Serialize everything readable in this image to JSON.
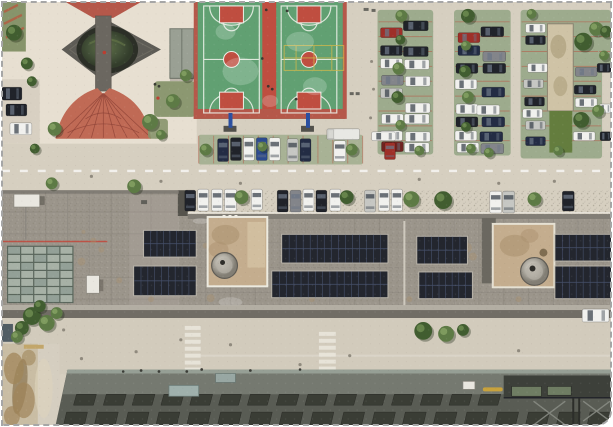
{
  "image": {
    "kind": "aerial-drone-photo",
    "caption": "Top-down drone view of a campus block: plaza with circular pond, two basketball courts, tree-lined parking lots full of cars, a long rooftop with solar panel arrays and two dome skylights, zebra crosswalks, and a dark building facade at the bottom"
  },
  "colors": {
    "base": "#d6cfc0",
    "plaza": "#e7dfd1",
    "streetTint": "#d8d0c2",
    "southRoad": "#d2cbbc",
    "lawn": "#87946b",
    "treeDark": "#415d30",
    "treeMid": "#5d7a45",
    "brickRed": "#b5584a",
    "fanRed": "#c06a55",
    "fanLine": "#8c4136",
    "diamond": "#5d5b55",
    "walk": "#6b6760",
    "pondRim": "#2c2f27",
    "canopy": "#9aa094",
    "courtGreen": "#61a072",
    "courtRed": "#bf4e40",
    "courtLine": "#edf1e9",
    "courtYellow": "#cfb84b",
    "postBlue": "#2b4fa0",
    "bayGreen": "#9dab8d",
    "bayLine": "#b5604c",
    "bandGreen": "#a8b295",
    "shed": "#cfc3a6",
    "shedLawn": "#647d3e",
    "roof": "#9b958b",
    "annexEast": "#a49e94",
    "parapetDark": "#716d65",
    "parapetLight": "#b3aea3",
    "gap": "#55534c",
    "redLine": "#c2473a",
    "skyFrame": "#5a665c",
    "skyPaneA": "#a7b1a6",
    "skyPaneB": "#93a097",
    "unit": "#e9e7e0",
    "solar": "#23262e",
    "solarLine": "#46506a",
    "solarFrame": "#bdb9ae",
    "penthouse": "#c4ad8e",
    "penthouse2": "#d3c0a1",
    "stain": "#a9906d",
    "domeDark": "#5f5c55",
    "darkStrip": "#6b6860",
    "crosswalk": "#e9e6dc",
    "dirt": "#c9bda4",
    "dirtBrown": "#a0855a",
    "mud": "#8a7550",
    "buildTop": "#757970",
    "buildFace": "#595c54",
    "buildEdge": "#9aa399",
    "buildWin": "#3a3d35",
    "teal": "#9fb0ac",
    "equip": "#3d403a",
    "equipGreen": "#6f7d63",
    "pipeYellow": "#c8a23c",
    "pipeGray": "#8b8e86",
    "spotMap": {
      "red": "#c23b2e",
      "dark": "#33342f",
      "gray": "#66655e",
      "man": "#8a8478"
    },
    "carColors": {
      "white": "#f1f1ee",
      "black": "#20232a",
      "silver": "#c6c7c3",
      "red": "#9e2f28",
      "blue": "#2c4a8e",
      "navy": "#232c44",
      "gray": "#83858a",
      "maroon": "#6e2320",
      "truck": "#e8e8e4"
    }
  },
  "scene": {
    "cars": [
      [
        381,
        26,
        22,
        10,
        "red"
      ],
      [
        404,
        19,
        25,
        10,
        "black"
      ],
      [
        381,
        44,
        22,
        10,
        "black"
      ],
      [
        404,
        45,
        25,
        10,
        "black"
      ],
      [
        381,
        57,
        22,
        10,
        "white"
      ],
      [
        405,
        58,
        25,
        10,
        "white"
      ],
      [
        382,
        74,
        22,
        10,
        "gray"
      ],
      [
        406,
        75,
        25,
        10,
        "white"
      ],
      [
        381,
        87,
        22,
        10,
        "silver"
      ],
      [
        406,
        102,
        25,
        10,
        "white"
      ],
      [
        382,
        113,
        22,
        10,
        "white"
      ],
      [
        405,
        113,
        25,
        10,
        "white"
      ],
      [
        381,
        130,
        22,
        10,
        "white"
      ],
      [
        406,
        131,
        25,
        10,
        "white"
      ],
      [
        382,
        141,
        22,
        10,
        "maroon"
      ],
      [
        405,
        142,
        25,
        10,
        "white"
      ],
      [
        459,
        31,
        22,
        10,
        "red"
      ],
      [
        482,
        25,
        23,
        10,
        "black"
      ],
      [
        459,
        44,
        22,
        10,
        "navy"
      ],
      [
        484,
        50,
        23,
        10,
        "gray"
      ],
      [
        457,
        62,
        22,
        10,
        "black"
      ],
      [
        484,
        62,
        23,
        10,
        "black"
      ],
      [
        456,
        78,
        22,
        10,
        "white"
      ],
      [
        483,
        86,
        23,
        10,
        "navy"
      ],
      [
        457,
        103,
        22,
        10,
        "white"
      ],
      [
        478,
        104,
        23,
        10,
        "white"
      ],
      [
        457,
        116,
        22,
        10,
        "black"
      ],
      [
        483,
        116,
        23,
        10,
        "navy"
      ],
      [
        456,
        130,
        22,
        10,
        "white"
      ],
      [
        481,
        131,
        23,
        10,
        "navy"
      ],
      [
        458,
        142,
        22,
        10,
        "white"
      ],
      [
        482,
        143,
        23,
        10,
        "gray"
      ],
      [
        527,
        22,
        20,
        9,
        "white"
      ],
      [
        527,
        34,
        20,
        9,
        "black"
      ],
      [
        529,
        62,
        20,
        9,
        "white"
      ],
      [
        525,
        78,
        20,
        9,
        "silver"
      ],
      [
        526,
        96,
        20,
        9,
        "black"
      ],
      [
        524,
        108,
        20,
        9,
        "white"
      ],
      [
        527,
        120,
        20,
        9,
        "silver"
      ],
      [
        527,
        136,
        20,
        9,
        "navy"
      ],
      [
        577,
        66,
        22,
        9,
        "gray"
      ],
      [
        576,
        84,
        22,
        9,
        "black"
      ],
      [
        577,
        97,
        22,
        9,
        "white"
      ],
      [
        575,
        131,
        22,
        9,
        "white"
      ],
      [
        599,
        62,
        14,
        9,
        "black"
      ],
      [
        601,
        103,
        12,
        9,
        "white"
      ],
      [
        602,
        131,
        11,
        9,
        "black"
      ],
      [
        217,
        138,
        11,
        23,
        "navy"
      ],
      [
        230,
        137,
        11,
        23,
        "black"
      ],
      [
        243,
        137,
        11,
        23,
        "white"
      ],
      [
        256,
        137,
        11,
        23,
        "blue"
      ],
      [
        269,
        137,
        11,
        23,
        "white"
      ],
      [
        287,
        138,
        11,
        23,
        "silver"
      ],
      [
        300,
        138,
        11,
        23,
        "navy"
      ],
      [
        334,
        140,
        12,
        21,
        "white"
      ],
      [
        327,
        128,
        33,
        11,
        "truck"
      ],
      [
        372,
        131,
        24,
        9,
        "white"
      ],
      [
        385,
        142,
        11,
        17,
        "red"
      ],
      [
        184,
        190,
        11,
        21,
        "black"
      ],
      [
        197,
        189,
        11,
        22,
        "white"
      ],
      [
        211,
        189,
        11,
        22,
        "white"
      ],
      [
        224,
        189,
        12,
        22,
        "white"
      ],
      [
        251,
        189,
        11,
        21,
        "white"
      ],
      [
        277,
        190,
        11,
        22,
        "black"
      ],
      [
        290,
        190,
        11,
        22,
        "gray"
      ],
      [
        303,
        189,
        11,
        22,
        "white"
      ],
      [
        316,
        190,
        11,
        22,
        "black"
      ],
      [
        330,
        189,
        11,
        22,
        "white"
      ],
      [
        365,
        190,
        11,
        22,
        "silver"
      ],
      [
        379,
        189,
        11,
        22,
        "white"
      ],
      [
        392,
        189,
        11,
        22,
        "white"
      ],
      [
        491,
        191,
        12,
        22,
        "white"
      ],
      [
        504,
        191,
        12,
        22,
        "silver"
      ],
      [
        564,
        191,
        12,
        20,
        "black"
      ],
      [
        0,
        86,
        20,
        13,
        "black"
      ],
      [
        4,
        103,
        21,
        12,
        "black"
      ],
      [
        8,
        122,
        22,
        12,
        "white"
      ],
      [
        584,
        310,
        27,
        13,
        "white"
      ]
    ],
    "trees": [
      [
        12,
        31,
        8,
        "d"
      ],
      [
        25,
        62,
        6,
        "d"
      ],
      [
        30,
        80,
        5,
        "d"
      ],
      [
        33,
        148,
        5,
        "d"
      ],
      [
        53,
        128,
        7,
        "m"
      ],
      [
        149,
        121,
        8,
        "m"
      ],
      [
        160,
        134,
        5,
        "m"
      ],
      [
        172,
        100,
        7,
        "m"
      ],
      [
        185,
        74,
        6,
        "m"
      ],
      [
        50,
        183,
        6,
        "m"
      ],
      [
        133,
        186,
        7,
        "m"
      ],
      [
        205,
        149,
        6,
        "m"
      ],
      [
        262,
        146,
        5,
        "m"
      ],
      [
        352,
        149,
        6,
        "m"
      ],
      [
        402,
        14,
        6,
        "m"
      ],
      [
        401,
        38,
        5,
        "d"
      ],
      [
        399,
        67,
        6,
        "m"
      ],
      [
        398,
        96,
        6,
        "d"
      ],
      [
        401,
        124,
        5,
        "m"
      ],
      [
        469,
        14,
        7,
        "d"
      ],
      [
        467,
        44,
        5,
        "m"
      ],
      [
        466,
        70,
        6,
        "d"
      ],
      [
        469,
        96,
        6,
        "m"
      ],
      [
        467,
        126,
        5,
        "d"
      ],
      [
        472,
        148,
        5,
        "m"
      ],
      [
        533,
        12,
        5,
        "m"
      ],
      [
        585,
        40,
        9,
        "d"
      ],
      [
        598,
        27,
        7,
        "m"
      ],
      [
        583,
        119,
        8,
        "d"
      ],
      [
        600,
        110,
        6,
        "m"
      ],
      [
        560,
        150,
        5,
        "m"
      ],
      [
        420,
        150,
        5,
        "m"
      ],
      [
        490,
        152,
        5,
        "m"
      ],
      [
        608,
        30,
        6,
        "d"
      ],
      [
        606,
        54,
        5,
        "m"
      ],
      [
        241,
        197,
        7,
        "m"
      ],
      [
        347,
        197,
        7,
        "d"
      ],
      [
        412,
        199,
        8,
        "m"
      ],
      [
        444,
        200,
        9,
        "d"
      ],
      [
        536,
        199,
        7,
        "m"
      ],
      [
        424,
        332,
        9,
        "d"
      ],
      [
        447,
        335,
        8,
        "m"
      ],
      [
        464,
        331,
        6,
        "d"
      ],
      [
        30,
        317,
        9,
        "d"
      ],
      [
        45,
        324,
        8,
        "m"
      ],
      [
        20,
        329,
        7,
        "d"
      ],
      [
        55,
        314,
        6,
        "m"
      ],
      [
        38,
        307,
        6,
        "d"
      ],
      [
        15,
        338,
        6,
        "m"
      ]
    ],
    "solar": [
      [
        143,
        231,
        52,
        26,
        8
      ],
      [
        133,
        267,
        62,
        29,
        9
      ],
      [
        282,
        235,
        106,
        28,
        15
      ],
      [
        272,
        272,
        116,
        26,
        16
      ],
      [
        418,
        237,
        50,
        27,
        7
      ],
      [
        420,
        273,
        53,
        26,
        8
      ],
      [
        557,
        235,
        56,
        26,
        8
      ],
      [
        557,
        267,
        56,
        32,
        8
      ]
    ],
    "bays": [
      {
        "x": 378,
        "y": 8,
        "w": 56,
        "h": 146
      },
      {
        "x": 455,
        "y": 8,
        "w": 57,
        "h": 147
      },
      {
        "x": 522,
        "y": 8,
        "w": 82,
        "h": 150
      },
      {
        "x": 600,
        "y": 8,
        "w": 13,
        "h": 60
      }
    ],
    "band": {
      "x": 198,
      "y": 134,
      "w": 165,
      "h": 30,
      "step": 15
    },
    "bayStep": 15,
    "skylight": {
      "x": 5,
      "y": 246,
      "w": 67,
      "h": 58,
      "cols": 5,
      "rows": 7
    },
    "crosswalks": [
      {
        "x": 184,
        "y": 327,
        "w": 16,
        "bar": 4,
        "gap": 3,
        "n": 7
      },
      {
        "x": 319,
        "y": 333,
        "w": 17,
        "bar": 4,
        "gap": 3,
        "n": 6
      }
    ],
    "windows": {
      "rows": [
        {
          "y": 396,
          "h": 11,
          "w": 20,
          "xs": [
            72,
            102,
            131,
            160,
            189,
            218,
            247,
            276,
            305,
            334,
            363,
            392,
            421,
            450,
            479
          ]
        },
        {
          "y": 414,
          "h": 13,
          "w": 21,
          "xs": [
            62,
            93,
            124,
            155,
            186,
            217,
            248,
            279,
            310,
            341,
            372,
            403,
            434,
            465,
            496,
            527,
            558,
            589
          ]
        }
      ]
    },
    "spots": [
      [
        103,
        51,
        1.8,
        "red"
      ],
      [
        157,
        97,
        1.6,
        "red"
      ],
      [
        154,
        83,
        1.4,
        "dark"
      ],
      [
        158,
        85,
        1.4,
        "dark"
      ],
      [
        266,
        8,
        1.4,
        "dark"
      ],
      [
        287,
        9,
        1.4,
        "dark"
      ],
      [
        268,
        85,
        1.4,
        "dark"
      ],
      [
        272,
        88,
        1.4,
        "dark"
      ],
      [
        296,
        98,
        1.4,
        "dark"
      ],
      [
        262,
        57,
        1.3,
        "dark"
      ],
      [
        140,
        372,
        1.4,
        "dark"
      ],
      [
        158,
        373,
        1.4,
        "dark"
      ],
      [
        186,
        373,
        1.4,
        "dark"
      ],
      [
        201,
        371,
        1.4,
        "dark"
      ],
      [
        250,
        372,
        1.4,
        "dark"
      ],
      [
        300,
        371,
        1.3,
        "dark"
      ],
      [
        122,
        373,
        1.3,
        "dark"
      ],
      [
        90,
        176,
        1.6,
        "man"
      ],
      [
        160,
        181,
        1.6,
        "man"
      ],
      [
        240,
        183,
        1.6,
        "man"
      ],
      [
        420,
        179,
        1.6,
        "man"
      ],
      [
        500,
        183,
        1.6,
        "man"
      ],
      [
        556,
        181,
        1.6,
        "man"
      ],
      [
        80,
        360,
        1.6,
        "man"
      ],
      [
        230,
        346,
        1.6,
        "man"
      ],
      [
        350,
        357,
        1.6,
        "man"
      ],
      [
        520,
        352,
        1.6,
        "man"
      ],
      [
        300,
        366,
        1.6,
        "man"
      ],
      [
        180,
        341,
        1.6,
        "man"
      ],
      [
        135,
        353,
        1.6,
        "man"
      ],
      [
        62,
        331,
        1.6,
        "man"
      ],
      [
        372,
        60,
        1.5,
        "man"
      ],
      [
        374,
        88,
        1.5,
        "man"
      ],
      [
        371,
        117,
        1.5,
        "man"
      ]
    ],
    "objects": [
      [
        350,
        91,
        4,
        3
      ],
      [
        356,
        91,
        4,
        3
      ],
      [
        364,
        6,
        5,
        3
      ],
      [
        372,
        7,
        4,
        3
      ],
      [
        140,
        200,
        6,
        4
      ]
    ],
    "stains": [
      [
        150,
        300,
        3
      ],
      [
        210,
        299,
        4
      ],
      [
        250,
        309,
        3
      ],
      [
        300,
        252,
        3
      ],
      [
        312,
        300,
        3
      ],
      [
        360,
        311,
        4
      ],
      [
        468,
        248,
        5
      ],
      [
        474,
        257,
        4
      ],
      [
        162,
        240,
        2
      ],
      [
        230,
        224,
        3
      ],
      [
        410,
        300,
        3
      ],
      [
        520,
        300,
        3
      ],
      [
        588,
        309,
        3
      ],
      [
        100,
        250,
        3
      ],
      [
        82,
        232,
        2
      ],
      [
        118,
        281,
        3
      ],
      [
        80,
        262,
        4
      ],
      [
        92,
        241,
        3
      ],
      [
        205,
        246,
        3
      ],
      [
        258,
        230,
        2
      ]
    ],
    "patches": [
      [
        230,
        303,
        12,
        5
      ],
      [
        155,
        312,
        9,
        4
      ],
      [
        370,
        310,
        12,
        4
      ],
      [
        545,
        310,
        10,
        4
      ],
      [
        200,
        221,
        8,
        3
      ],
      [
        430,
        310,
        9,
        4
      ],
      [
        240,
        70,
        18,
        14
      ],
      [
        300,
        40,
        14,
        10
      ],
      [
        225,
        30,
        10,
        8
      ],
      [
        315,
        85,
        12,
        9
      ],
      [
        270,
        100,
        8,
        6
      ]
    ]
  }
}
